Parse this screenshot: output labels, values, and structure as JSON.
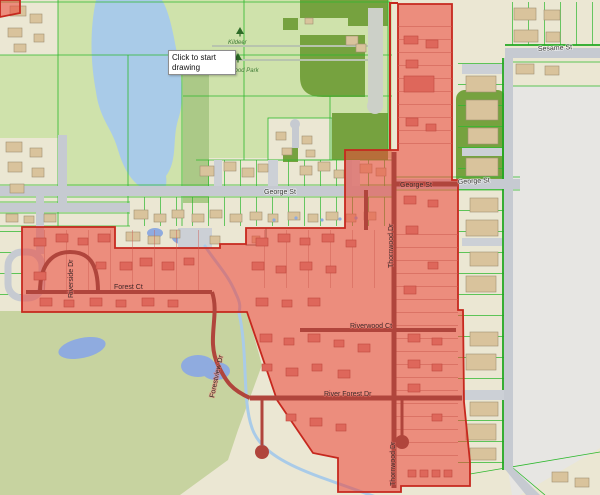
{
  "tooltip": {
    "text": "Click to start drawing"
  },
  "labels": {
    "streets": [
      {
        "name": "george-st-west",
        "text": "George St"
      },
      {
        "name": "george-st-mid",
        "text": "George St"
      },
      {
        "name": "george-st-east",
        "text": "George St"
      },
      {
        "name": "sesame-st",
        "text": "Sesame St"
      },
      {
        "name": "river-forest-dr",
        "text": "River Forest Dr"
      },
      {
        "name": "riverwood-ct",
        "text": "Riverwood Ct"
      },
      {
        "name": "thornwood-upper",
        "text": "Thornwood Dr"
      },
      {
        "name": "thornwood-lower",
        "text": "Thornwood Dr"
      },
      {
        "name": "forestview-dr",
        "text": "Forestview Dr"
      },
      {
        "name": "riverside-dr",
        "text": "Riverside Dr"
      },
      {
        "name": "forest-ct",
        "text": "Forest Ct"
      }
    ],
    "parks": [
      {
        "name": "kildeer",
        "text": "Kildeer"
      },
      {
        "name": "wilwood-park",
        "text": "Wilwood Park"
      }
    ]
  },
  "colors": {
    "parcel": "#ebe7d3",
    "gray-zone": "#e7e6e3",
    "park": "#cfe2ab",
    "park-med": "#abc987",
    "field": "#76a23f",
    "sage": "#c7d3a0",
    "water": "#a9cbe8",
    "pond": "#8fabdf",
    "road": "#c6cad1",
    "bldg": "#d9c39c",
    "bldg-red": "#de675b",
    "green-line": "#2db82d",
    "red-fill": "rgba(237,67,55,0.55)",
    "red-border": "#c6281e",
    "red-road": "#b0453c",
    "tooltip-bg": "#ffffff",
    "tooltip-border": "#8e8e8e"
  }
}
